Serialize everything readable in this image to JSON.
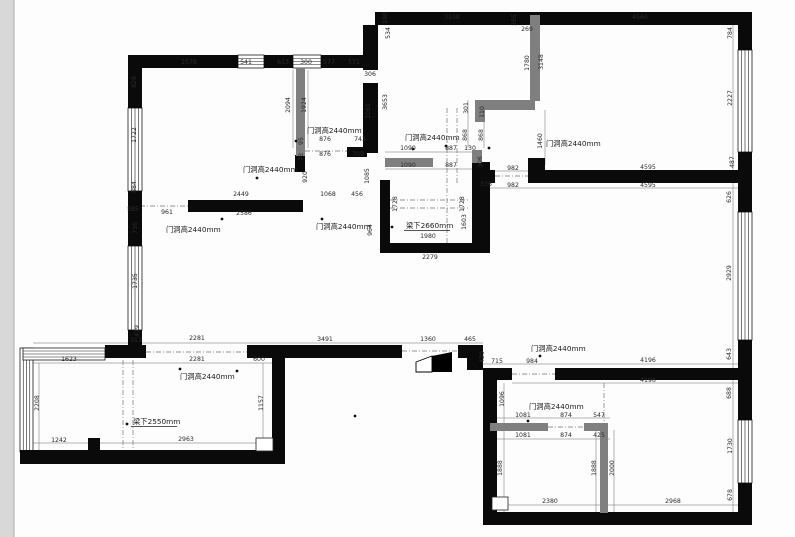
{
  "drawing": {
    "type": "floor-plan",
    "units": "mm",
    "annotation_door": "门洞高2440mm",
    "annotation_beam_2660": "梁下2660mm",
    "annotation_beam_2550": "梁下2550mm",
    "colors": {
      "wall": "#0a0a0a",
      "new_wall": "#7f7f7f",
      "dim_text": "#2b2b2b",
      "dim_line": "#6a6a6a",
      "dash_line": "#707070",
      "page_strip": "#d8d8d8",
      "window_stroke": "#1a1a1a"
    },
    "walls_black": [
      [
        375,
        12,
        377,
        13
      ],
      [
        738,
        25,
        14,
        25
      ],
      [
        738,
        152,
        14,
        60
      ],
      [
        738,
        340,
        14,
        80
      ],
      [
        738,
        483,
        14,
        42
      ],
      [
        483,
        512,
        269,
        13
      ],
      [
        483,
        368,
        14,
        157
      ],
      [
        483,
        368,
        29,
        12
      ],
      [
        555,
        368,
        185,
        12
      ],
      [
        458,
        345,
        25,
        13
      ],
      [
        467,
        356,
        16,
        14
      ],
      [
        105,
        345,
        41,
        13
      ],
      [
        247,
        345,
        155,
        13
      ],
      [
        20,
        450,
        265,
        14
      ],
      [
        272,
        356,
        13,
        108
      ],
      [
        88,
        438,
        12,
        13
      ],
      [
        128,
        55,
        110,
        13
      ],
      [
        264,
        55,
        29,
        13
      ],
      [
        321,
        55,
        57,
        13
      ],
      [
        128,
        55,
        14,
        53
      ],
      [
        128,
        191,
        14,
        55
      ],
      [
        128,
        330,
        14,
        28
      ],
      [
        188,
        200,
        115,
        12
      ],
      [
        295,
        155,
        10,
        17
      ],
      [
        347,
        147,
        20,
        10
      ],
      [
        363,
        25,
        15,
        45
      ],
      [
        363,
        83,
        15,
        70
      ],
      [
        380,
        180,
        10,
        73
      ],
      [
        472,
        162,
        18,
        91
      ],
      [
        380,
        243,
        100,
        10
      ],
      [
        531,
        170,
        209,
        13
      ],
      [
        472,
        170,
        23,
        13
      ],
      [
        528,
        158,
        17,
        25
      ]
    ],
    "walls_gray": [
      [
        296,
        68,
        9,
        88
      ],
      [
        385,
        158,
        48,
        9
      ],
      [
        475,
        100,
        60,
        10
      ],
      [
        475,
        110,
        10,
        12
      ],
      [
        530,
        15,
        10,
        86
      ],
      [
        472,
        150,
        10,
        13
      ],
      [
        490,
        423,
        58,
        8
      ],
      [
        584,
        423,
        24,
        8
      ],
      [
        600,
        423,
        8,
        90
      ]
    ],
    "windows": [
      {
        "x": 238,
        "y": 55,
        "w": 26,
        "h": 13,
        "dir": "h"
      },
      {
        "x": 293,
        "y": 55,
        "w": 28,
        "h": 13,
        "dir": "h"
      },
      {
        "x": 128,
        "y": 108,
        "w": 14,
        "h": 83,
        "dir": "v"
      },
      {
        "x": 128,
        "y": 246,
        "w": 14,
        "h": 84,
        "dir": "v"
      },
      {
        "x": 738,
        "y": 50,
        "w": 14,
        "h": 102,
        "dir": "v"
      },
      {
        "x": 738,
        "y": 212,
        "w": 14,
        "h": 128,
        "dir": "v"
      },
      {
        "x": 738,
        "y": 420,
        "w": 14,
        "h": 63,
        "dir": "v"
      },
      {
        "x": 20,
        "y": 348,
        "w": 13,
        "h": 104,
        "dir": "v"
      },
      {
        "x": 23,
        "y": 348,
        "w": 82,
        "h": 12,
        "dir": "h"
      }
    ],
    "dim_lines": [
      [
        128,
        66,
        378,
        66
      ],
      [
        378,
        20,
        752,
        20
      ],
      [
        137,
        68,
        137,
        345
      ],
      [
        733,
        25,
        733,
        512
      ],
      [
        385,
        152,
        475,
        152
      ],
      [
        385,
        169,
        475,
        169
      ],
      [
        490,
        171,
        740,
        171
      ],
      [
        490,
        188,
        740,
        188
      ],
      [
        33,
        343,
        483,
        343
      ],
      [
        33,
        363,
        272,
        363
      ],
      [
        483,
        364,
        740,
        364
      ],
      [
        512,
        383,
        740,
        383
      ],
      [
        490,
        418,
        610,
        418
      ],
      [
        490,
        439,
        610,
        439
      ],
      [
        33,
        443,
        280,
        443
      ],
      [
        497,
        505,
        740,
        505
      ],
      [
        39,
        363,
        39,
        450
      ],
      [
        263,
        363,
        263,
        450
      ],
      [
        504,
        383,
        504,
        512
      ],
      [
        614,
        430,
        614,
        512
      ],
      [
        596,
        430,
        596,
        512
      ],
      [
        308,
        70,
        308,
        148
      ],
      [
        293,
        70,
        293,
        148
      ],
      [
        468,
        100,
        468,
        148
      ],
      [
        484,
        100,
        484,
        148
      ],
      [
        545,
        110,
        545,
        165
      ]
    ],
    "dash_lines": [
      [
        146,
        352,
        247,
        352
      ],
      [
        402,
        351,
        458,
        351
      ],
      [
        140,
        206,
        188,
        206
      ],
      [
        512,
        374,
        555,
        374
      ],
      [
        548,
        427,
        584,
        427
      ],
      [
        495,
        176,
        531,
        176
      ],
      [
        447,
        108,
        447,
        253
      ],
      [
        457,
        108,
        457,
        183
      ],
      [
        390,
        200,
        470,
        200
      ],
      [
        390,
        208,
        470,
        208
      ],
      [
        305,
        151,
        347,
        151
      ],
      [
        123,
        360,
        123,
        450
      ],
      [
        133,
        360,
        133,
        450
      ],
      [
        604,
        383,
        604,
        423
      ]
    ],
    "outline_rects": [
      [
        256,
        438,
        17,
        13
      ],
      [
        492,
        497,
        16,
        13
      ]
    ],
    "dots": [
      [
        296,
        141
      ],
      [
        257,
        178
      ],
      [
        222,
        219
      ],
      [
        322,
        219
      ],
      [
        413,
        149
      ],
      [
        489,
        148
      ],
      [
        540,
        356
      ],
      [
        180,
        369
      ],
      [
        528,
        421
      ],
      [
        392,
        227
      ],
      [
        127,
        424
      ],
      [
        446,
        146
      ],
      [
        355,
        416
      ],
      [
        237,
        371
      ]
    ],
    "door_wedge": {
      "white": "416,362 432,356 432,372 416,372",
      "black": "432,356 452,352 452,372 432,372"
    },
    "dim_labels": [
      {
        "t": "2578",
        "x": 189,
        "y": 64
      },
      {
        "t": "541",
        "x": 246,
        "y": 64
      },
      {
        "t": "613",
        "x": 283,
        "y": 64
      },
      {
        "t": "300",
        "x": 306,
        "y": 64
      },
      {
        "t": "577",
        "x": 329,
        "y": 64
      },
      {
        "t": "571",
        "x": 354,
        "y": 64
      },
      {
        "t": "828",
        "x": 136,
        "y": 82,
        "r": 1
      },
      {
        "t": "1722",
        "x": 136,
        "y": 135,
        "r": 1
      },
      {
        "t": "884",
        "x": 136,
        "y": 187,
        "r": 1
      },
      {
        "t": "585",
        "x": 133,
        "y": 211
      },
      {
        "t": "736",
        "x": 137,
        "y": 228,
        "r": 1
      },
      {
        "t": "1735",
        "x": 137,
        "y": 281,
        "r": 1
      },
      {
        "t": "419",
        "x": 139,
        "y": 331,
        "r": 1
      },
      {
        "t": "313",
        "x": 136,
        "y": 342
      },
      {
        "t": "3108",
        "x": 452,
        "y": 19
      },
      {
        "t": "265",
        "x": 516,
        "y": 20,
        "r": 1
      },
      {
        "t": "269",
        "x": 527,
        "y": 31
      },
      {
        "t": "4560",
        "x": 640,
        "y": 19
      },
      {
        "t": "190",
        "x": 387,
        "y": 18,
        "r": 1
      },
      {
        "t": "534",
        "x": 390,
        "y": 33,
        "r": 1
      },
      {
        "t": "3653",
        "x": 387,
        "y": 102,
        "r": 1
      },
      {
        "t": "306",
        "x": 370,
        "y": 76
      },
      {
        "t": "1061",
        "x": 370,
        "y": 111,
        "r": 1
      },
      {
        "t": "2094",
        "x": 290,
        "y": 105,
        "r": 1
      },
      {
        "t": "1924",
        "x": 306,
        "y": 105,
        "r": 1
      },
      {
        "t": "1780",
        "x": 529,
        "y": 63,
        "r": 1
      },
      {
        "t": "3148",
        "x": 543,
        "y": 62,
        "r": 1
      },
      {
        "t": "784",
        "x": 732,
        "y": 33,
        "r": 1
      },
      {
        "t": "2227",
        "x": 732,
        "y": 98,
        "r": 1
      },
      {
        "t": "487",
        "x": 734,
        "y": 162,
        "r": 1
      },
      {
        "t": "626",
        "x": 731,
        "y": 197,
        "r": 1
      },
      {
        "t": "2929",
        "x": 731,
        "y": 273,
        "r": 1
      },
      {
        "t": "643",
        "x": 731,
        "y": 354,
        "r": 1
      },
      {
        "t": "688",
        "x": 731,
        "y": 393,
        "r": 1
      },
      {
        "t": "1730",
        "x": 732,
        "y": 446,
        "r": 1
      },
      {
        "t": "678",
        "x": 732,
        "y": 495,
        "r": 1
      },
      {
        "t": "876",
        "x": 325,
        "y": 141
      },
      {
        "t": "743",
        "x": 360,
        "y": 141
      },
      {
        "t": "876",
        "x": 325,
        "y": 156
      },
      {
        "t": "709",
        "x": 358,
        "y": 156
      },
      {
        "t": "95",
        "x": 303,
        "y": 141,
        "r": 1
      },
      {
        "t": "73",
        "x": 303,
        "y": 157,
        "r": 1
      },
      {
        "t": "920",
        "x": 307,
        "y": 177,
        "r": 1
      },
      {
        "t": "1085",
        "x": 369,
        "y": 176,
        "r": 1
      },
      {
        "t": "2449",
        "x": 241,
        "y": 196
      },
      {
        "t": "1068",
        "x": 328,
        "y": 196
      },
      {
        "t": "456",
        "x": 357,
        "y": 196
      },
      {
        "t": "961",
        "x": 167,
        "y": 214
      },
      {
        "t": "2586",
        "x": 244,
        "y": 215
      },
      {
        "t": "964",
        "x": 372,
        "y": 230,
        "r": 1
      },
      {
        "t": "1090",
        "x": 408,
        "y": 150
      },
      {
        "t": "887",
        "x": 451,
        "y": 150
      },
      {
        "t": "130",
        "x": 470,
        "y": 150
      },
      {
        "t": "1090",
        "x": 408,
        "y": 167
      },
      {
        "t": "887",
        "x": 451,
        "y": 167
      },
      {
        "t": "306",
        "x": 482,
        "y": 162,
        "r": 1
      },
      {
        "t": "301",
        "x": 468,
        "y": 108,
        "r": 1
      },
      {
        "t": "110",
        "x": 484,
        "y": 112,
        "r": 1
      },
      {
        "t": "868",
        "x": 467,
        "y": 135,
        "r": 1
      },
      {
        "t": "868",
        "x": 483,
        "y": 135,
        "r": 1
      },
      {
        "t": "1460",
        "x": 542,
        "y": 141,
        "r": 1
      },
      {
        "t": "336",
        "x": 486,
        "y": 186
      },
      {
        "t": "982",
        "x": 513,
        "y": 170
      },
      {
        "t": "982",
        "x": 513,
        "y": 187
      },
      {
        "t": "4595",
        "x": 648,
        "y": 169
      },
      {
        "t": "4595",
        "x": 648,
        "y": 187
      },
      {
        "t": "1728",
        "x": 397,
        "y": 204,
        "r": 1
      },
      {
        "t": "1728",
        "x": 464,
        "y": 204,
        "r": 1
      },
      {
        "t": "1603",
        "x": 466,
        "y": 222,
        "r": 1
      },
      {
        "t": "1980",
        "x": 428,
        "y": 238
      },
      {
        "t": "2279",
        "x": 430,
        "y": 259
      },
      {
        "t": "2281",
        "x": 197,
        "y": 340
      },
      {
        "t": "3491",
        "x": 325,
        "y": 341
      },
      {
        "t": "1360",
        "x": 428,
        "y": 341
      },
      {
        "t": "465",
        "x": 470,
        "y": 341
      },
      {
        "t": "420",
        "x": 484,
        "y": 357,
        "r": 1
      },
      {
        "t": "715",
        "x": 497,
        "y": 363
      },
      {
        "t": "984",
        "x": 532,
        "y": 363
      },
      {
        "t": "2281",
        "x": 197,
        "y": 361
      },
      {
        "t": "600",
        "x": 259,
        "y": 361
      },
      {
        "t": "1623",
        "x": 69,
        "y": 361
      },
      {
        "t": "2208",
        "x": 39,
        "y": 403,
        "r": 1
      },
      {
        "t": "1157",
        "x": 263,
        "y": 403,
        "r": 1
      },
      {
        "t": "1242",
        "x": 59,
        "y": 442
      },
      {
        "t": "2963",
        "x": 186,
        "y": 441
      },
      {
        "t": "4196",
        "x": 648,
        "y": 362
      },
      {
        "t": "4196",
        "x": 648,
        "y": 382
      },
      {
        "t": "1096",
        "x": 504,
        "y": 399,
        "r": 1
      },
      {
        "t": "1081",
        "x": 523,
        "y": 417
      },
      {
        "t": "874",
        "x": 566,
        "y": 417
      },
      {
        "t": "547",
        "x": 599,
        "y": 417
      },
      {
        "t": "1081",
        "x": 523,
        "y": 437
      },
      {
        "t": "874",
        "x": 566,
        "y": 437
      },
      {
        "t": "425",
        "x": 599,
        "y": 437
      },
      {
        "t": "1888",
        "x": 502,
        "y": 468,
        "r": 1
      },
      {
        "t": "1888",
        "x": 596,
        "y": 468,
        "r": 1
      },
      {
        "t": "2000",
        "x": 614,
        "y": 468,
        "r": 1
      },
      {
        "t": "2380",
        "x": 550,
        "y": 503
      },
      {
        "t": "2968",
        "x": 673,
        "y": 503
      }
    ],
    "cn_labels": [
      {
        "t": "门洞高2440mm",
        "x": 307,
        "y": 133
      },
      {
        "t": "门洞高2440mm",
        "x": 243,
        "y": 172
      },
      {
        "t": "门洞高2440mm",
        "x": 166,
        "y": 232
      },
      {
        "t": "门洞高2440mm",
        "x": 316,
        "y": 229
      },
      {
        "t": "门洞高2440mm",
        "x": 405,
        "y": 140
      },
      {
        "t": "门洞高2440mm",
        "x": 546,
        "y": 146
      },
      {
        "t": "门洞高2440mm",
        "x": 531,
        "y": 351
      },
      {
        "t": "门洞高2440mm",
        "x": 180,
        "y": 379
      },
      {
        "t": "门洞高2440mm",
        "x": 529,
        "y": 409
      },
      {
        "t": "梁下2660mm",
        "x": 406,
        "y": 228,
        "u": 1
      },
      {
        "t": "梁下2550mm",
        "x": 133,
        "y": 424,
        "u": 1
      }
    ]
  }
}
